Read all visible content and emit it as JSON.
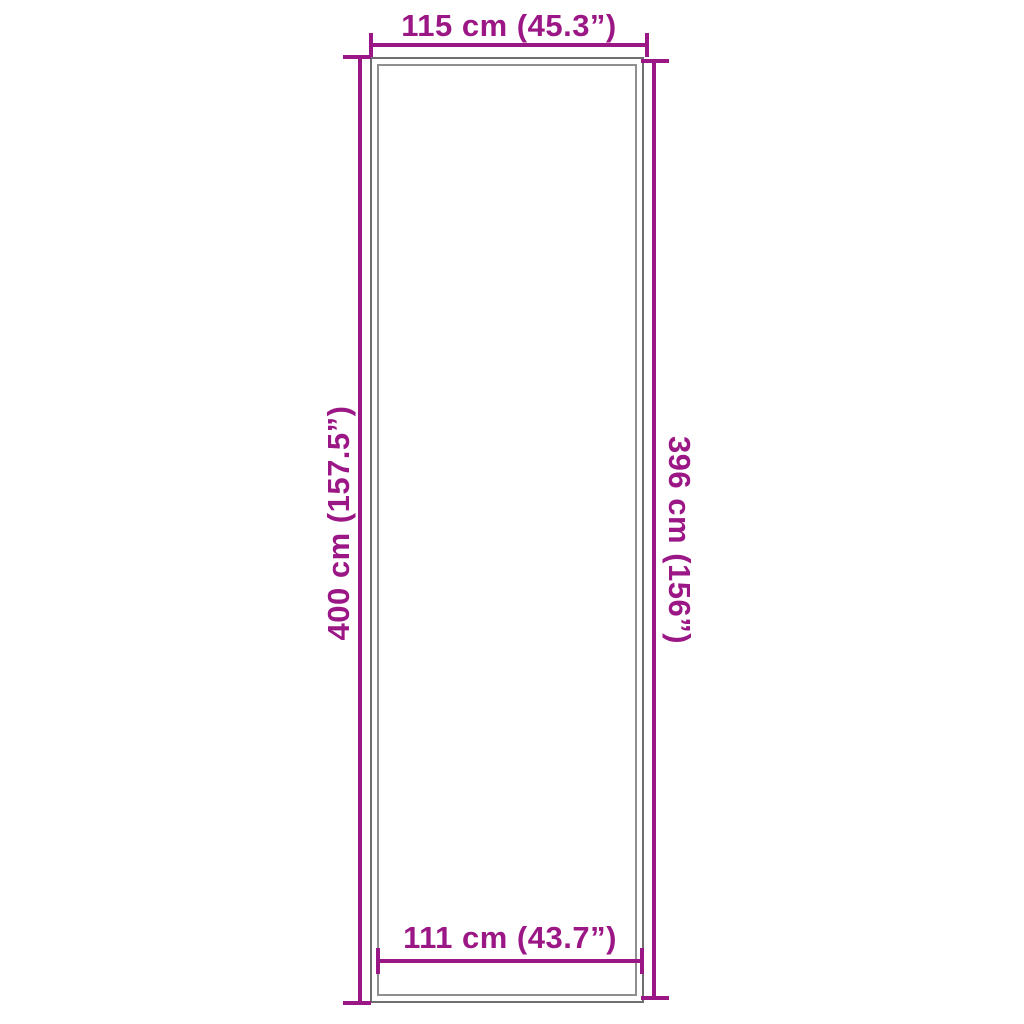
{
  "diagram": {
    "kind": "product-dimension-diagram",
    "colors": {
      "dimension_accent": "#9b1786",
      "outline_outer": "#6e6e6e",
      "outline_inner": "#8f8f8f",
      "background": "#ffffff"
    }
  },
  "dimensions": {
    "top": {
      "label": "115 cm (45.3”)",
      "cm": 115,
      "inches": 45.3
    },
    "left": {
      "label": "400 cm (157.5”)",
      "cm": 400,
      "inches": 157.5
    },
    "right": {
      "label": "396 cm (156”)",
      "cm": 396,
      "inches": 156
    },
    "bottom": {
      "label": "111 cm (43.7”)",
      "cm": 111,
      "inches": 43.7
    }
  }
}
